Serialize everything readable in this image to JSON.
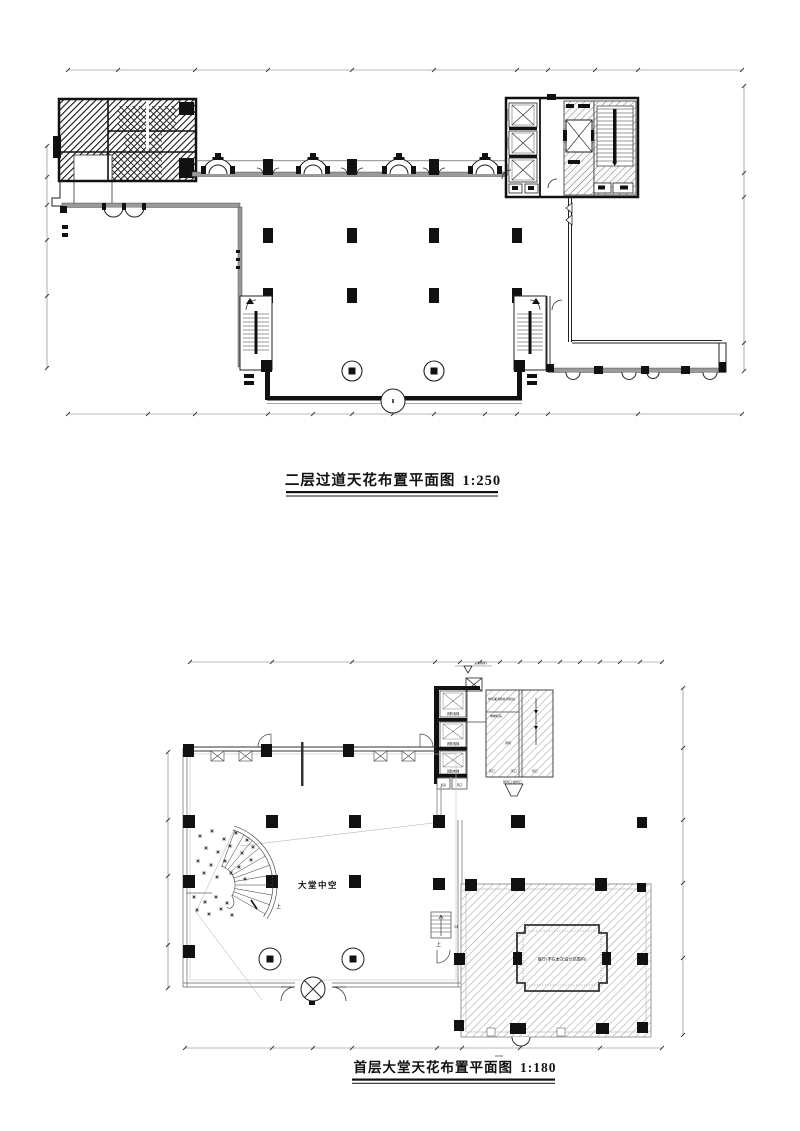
{
  "colors": {
    "line": "#1a1a1a",
    "gray_wall": "#9a9a9a",
    "dim_line": "#777777",
    "paper": "#ffffff"
  },
  "upper_plan": {
    "title": "二层过道天花布置平面图",
    "scale": "1:250"
  },
  "lower_plan": {
    "title": "首层大堂天花布置平面图",
    "scale": "1:180",
    "labels": {
      "atrium": "大堂中空",
      "restaurant": "餐厅(不在本次设计范围内)",
      "elevation": "±0.000",
      "up_spiral": "上",
      "up_east": "上",
      "stair_count": "14",
      "elevator": "消防电梯",
      "machine_room": "排风兼消防补风机房",
      "elevator_machine": "电梯机房",
      "fan": "风机",
      "vent_port": "风口",
      "air_note": "回风口/送风口",
      "small_room_a": "机房",
      "small_room_b": "风口"
    }
  }
}
